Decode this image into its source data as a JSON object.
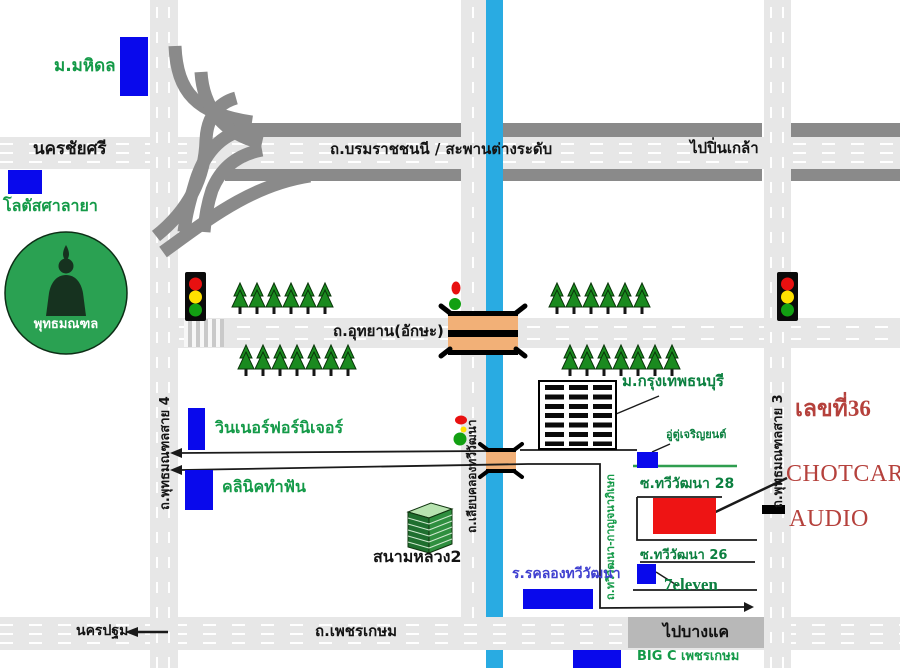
{
  "map": {
    "roads": {
      "highway_label": "ถ.บรมราชชนนี    /    สะพานต่างระดับ",
      "uthayan": "ถ.อุทยาน(อักษะ)",
      "sai4": "ถ.พุทธมณฑลสาย 4",
      "sai3": "ถ.พุทธมณฑลสาย 3",
      "liab_khlong": "ถ.เลียบคลองทวีวัฒนา",
      "thawi_kanchana": "ถ.ทวีวัฒนา-กาญจนาภิเษก",
      "phetkasem": "ถ.เพชรเกษม",
      "soi28": "ซ.ทวีวัฒนา 28",
      "soi26": "ซ.ทวีวัฒนา 26"
    },
    "directions": {
      "nakhon_chai_si": "นครชัยศรี",
      "pin_klao": "ไปปิ่นเกล้า",
      "nakhon_pathom": "นครปฐม",
      "bang_khae": "ไปบางแค"
    },
    "places": {
      "mahidol": "ม.มหิดล",
      "lotus_salaya": "โลตัสศาลายา",
      "phutthamonthon": "พุทธมณฑล",
      "winner_furniture": "วินเนอร์ฟอร์นิเจอร์",
      "dental_clinic": "คลินิคทำฟัน",
      "sanam_luang2": "สนามหลวง2",
      "bkk_thonburi_univ": "ม.กรุงเทพธนบุรี",
      "garage": "อู่ตู่เจริญยนต์",
      "khlong_school": "ร.รคลองทวีวัฒนา",
      "seven_eleven": "7eleven",
      "big_c": "BIG C เพชรเกษม"
    },
    "destination": {
      "address_no": "เลขที่36",
      "name_top": "CHOTCAR",
      "name_bottom": "AUDIO"
    },
    "colors": {
      "canal_blue": "#29abe2",
      "road_light": "#e7e7e7",
      "road_dark": "#8a8a8a",
      "landmark_blue": "#0909ec",
      "destination_red": "#ee1414",
      "label_green": "#149a48",
      "label_red": "#b5413c",
      "tree_green": "#1a8a1f",
      "park_green": "#2aa152"
    }
  }
}
